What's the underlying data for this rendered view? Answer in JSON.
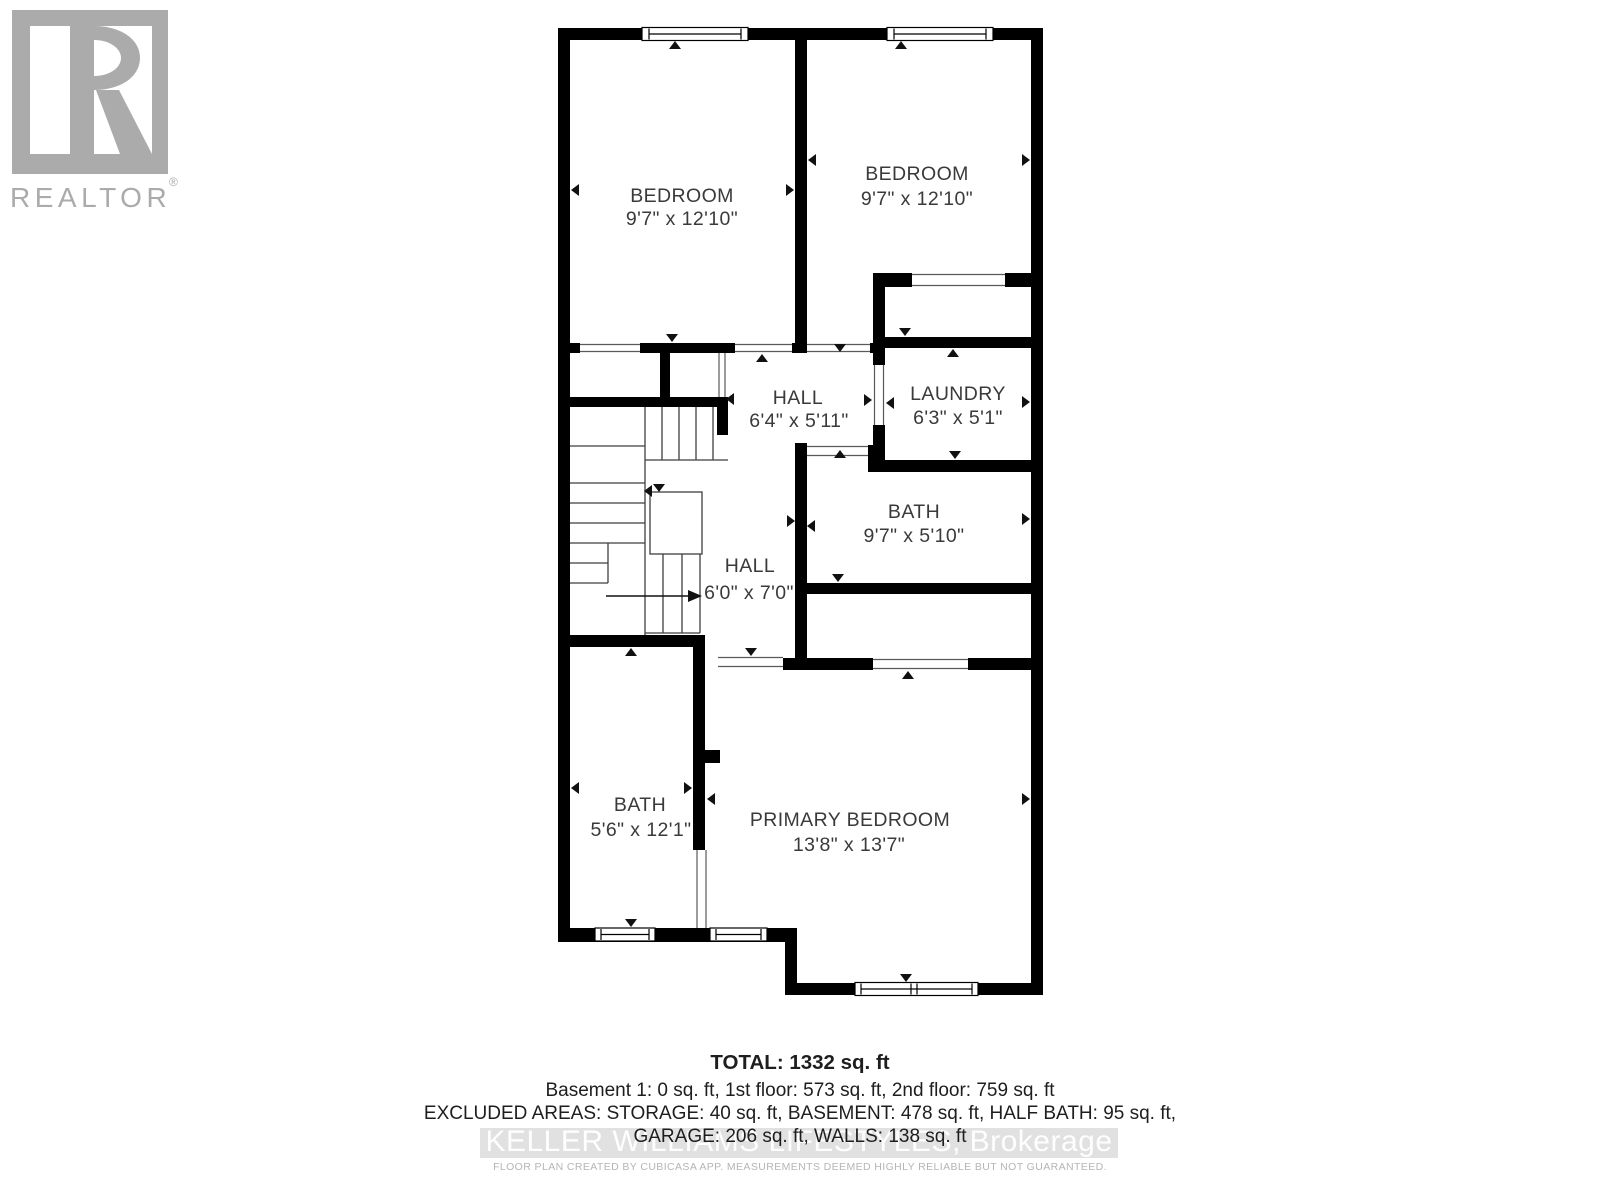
{
  "logo": {
    "brand": "REALTOR",
    "registered": "®"
  },
  "plan": {
    "rooms": [
      {
        "name": "BEDROOM",
        "dims": "9'7\" x 12'10\""
      },
      {
        "name": "BEDROOM",
        "dims": "9'7\" x 12'10\""
      },
      {
        "name": "HALL",
        "dims": "6'4\" x 5'11\""
      },
      {
        "name": "LAUNDRY",
        "dims": "6'3\" x 5'1\""
      },
      {
        "name": "BATH",
        "dims": "9'7\" x 5'10\""
      },
      {
        "name": "HALL",
        "dims": "6'0\" x 7'0\""
      },
      {
        "name": "BATH",
        "dims": "5'6\" x 12'1\""
      },
      {
        "name": "PRIMARY BEDROOM",
        "dims": "13'8\" x 13'7\""
      }
    ]
  },
  "summary": {
    "total": "TOTAL: 1332 sq. ft",
    "floors": "Basement 1: 0 sq. ft, 1st floor: 573 sq. ft, 2nd floor: 759 sq. ft",
    "excluded_1": "EXCLUDED AREAS: STORAGE: 40 sq. ft, BASEMENT: 478 sq. ft, HALF BATH: 95 sq. ft,",
    "excluded_2": "GARAGE: 206 sq. ft, WALLS: 138 sq. ft"
  },
  "watermark": "KELLER WILLIAMS LIFESTYLES, Brokerage",
  "disclaimer": "FLOOR PLAN CREATED BY CUBICASA APP. MEASUREMENTS DEEMED HIGHLY RELIABLE BUT NOT GUARANTEED.",
  "colors": {
    "wall": "#000000",
    "label": "#3a3a3a",
    "logo_gray": "#ababab",
    "watermark_bar": "#d9d9d9",
    "watermark_text": "#ffffff",
    "fineprint": "#b5b5b5"
  }
}
